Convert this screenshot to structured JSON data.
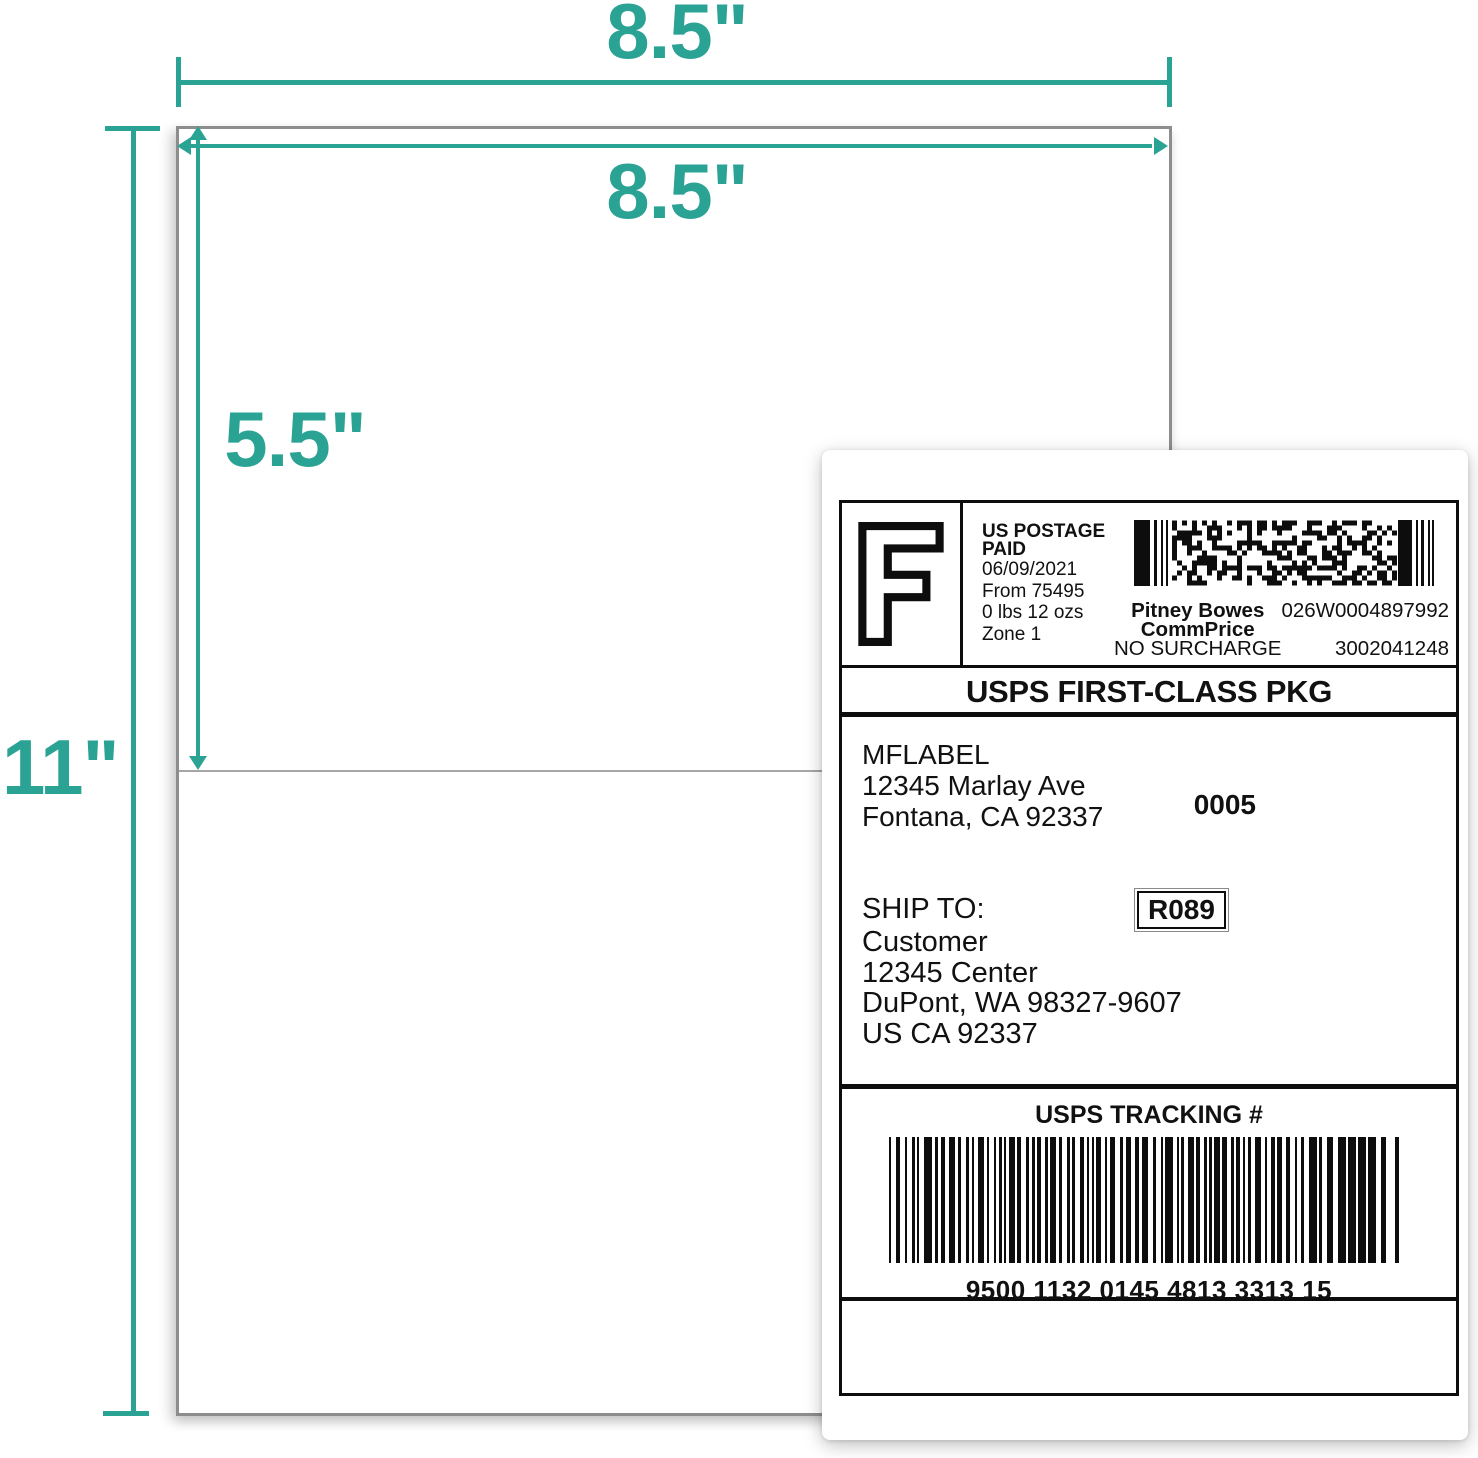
{
  "accent_color": "#2aa394",
  "dimensions": {
    "sheet_width_top": "8.5\"",
    "sheet_width_inner": "8.5\"",
    "half_height": "5.5\"",
    "sheet_height": "11\""
  },
  "label": {
    "indicia_letter": "F",
    "postage": {
      "line1": "US POSTAGE",
      "line2": "PAID",
      "date": "06/09/2021",
      "origin": "From 75495",
      "weight": "0 lbs 12 ozs",
      "zone": "Zone 1",
      "vendor": "Pitney Bowes",
      "rate_code": "CommPrice",
      "surcharge": "NO SURCHARGE",
      "meter_id": "026W0004897992",
      "serial": "3002041248"
    },
    "service": "USPS FIRST-CLASS PKG",
    "sender": {
      "name": "MFLABEL",
      "street": "12345 Marlay Ave",
      "city_state_zip": "Fontana, CA 92337"
    },
    "batch_code": "0005",
    "ship_to_heading": "SHIP TO:",
    "route_code": "R089",
    "recipient": {
      "line1": "Customer",
      "line2": "12345 Center",
      "line3": "DuPont, WA 98327-9607",
      "line4": "US CA 92337"
    },
    "tracking": {
      "heading": "USPS TRACKING #",
      "number": "9500 1132 0145 4813 3313 15"
    }
  }
}
